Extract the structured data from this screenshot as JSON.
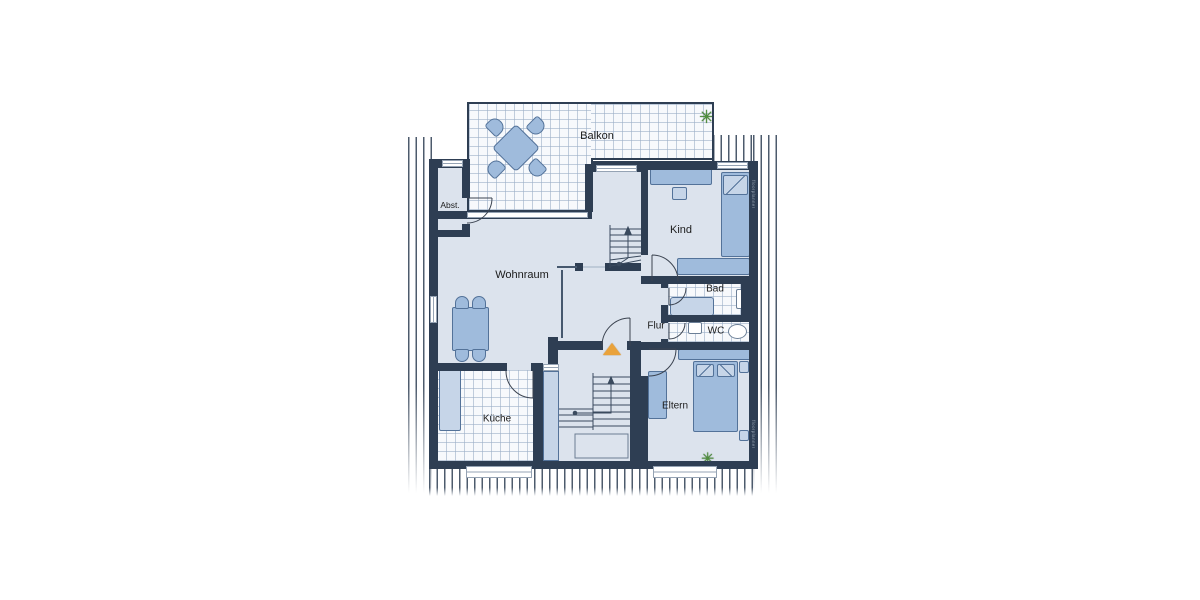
{
  "plan": {
    "type": "apartment-floor-plan",
    "rooms": {
      "balkon": {
        "label": "Balkon"
      },
      "abstellraum": {
        "label": "Abst."
      },
      "wohnraum": {
        "label": "Wohnraum"
      },
      "kind": {
        "label": "Kind"
      },
      "bad": {
        "label": "Bad"
      },
      "wc": {
        "label": "WC"
      },
      "flur": {
        "label": "Flur"
      },
      "kueche": {
        "label": "Küche"
      },
      "eltern": {
        "label": "Eltern"
      }
    },
    "watermark": {
      "text": "floorplanner"
    },
    "icons": {
      "plant_glyph": "✳",
      "entrance_marker": "orange-triangle-up",
      "stairs": "tread-lines-with-walk-arrow",
      "roof_slope_hatch": "vertical-line-hatch"
    },
    "colors": {
      "wall": "#2e3e53",
      "floor": "#dce3ed",
      "tile_grid": "#9cafc7",
      "furniture": "#9fbbdc",
      "furniture_border": "#537299",
      "furniture_light": "#c6d5e8",
      "window": "#ffffff",
      "entrance_marker": "#e9a23b",
      "plant": "#4e8f3c"
    }
  }
}
